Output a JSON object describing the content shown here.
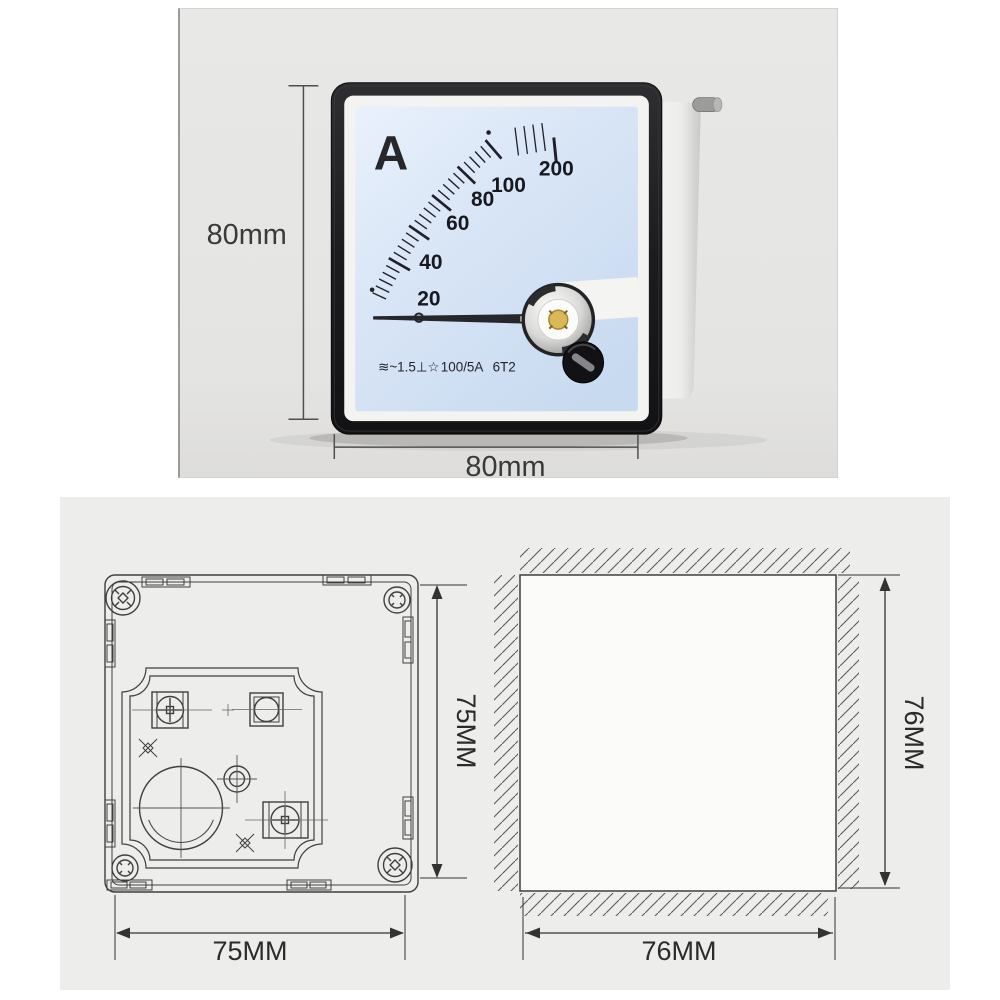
{
  "colors": {
    "photo_bg": "#e8e8e6",
    "drawings_bg": "#ededeb",
    "face_blue": "#d8e5f6",
    "bezel_black": "#1c1c1e",
    "line_color": "#3f3f3f"
  },
  "photo_panel": {
    "height_dim": "80mm",
    "width_dim": "80mm",
    "meter": {
      "unit": "A",
      "scale": [
        "20",
        "40",
        "60",
        "80",
        "100",
        "200"
      ],
      "marking_symbols": "≋~1.5⊥☆",
      "marking_ratio": "100/5A",
      "marking_model": "6T2"
    }
  },
  "drawings_panel": {
    "rear_view": {
      "height_dim": "75MM",
      "width_dim": "75MM"
    },
    "panel_cutout": {
      "height_dim": "76MM",
      "width_dim": "76MM"
    }
  }
}
